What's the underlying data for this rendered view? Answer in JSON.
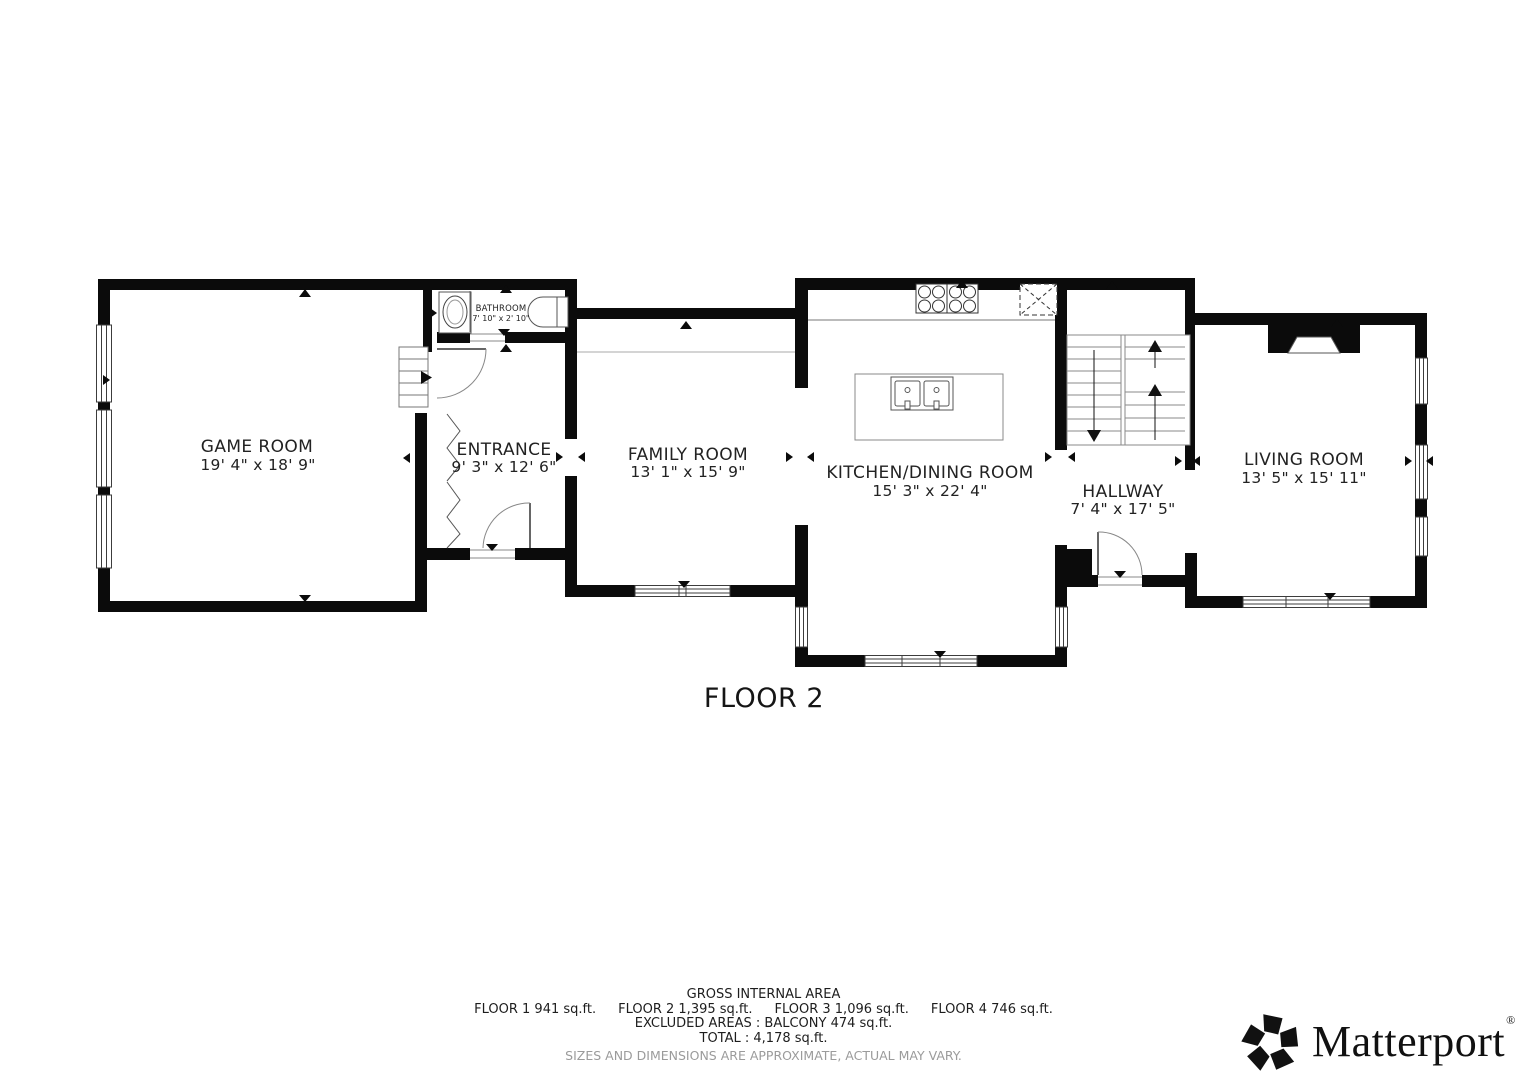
{
  "floor_plan": {
    "floor_label": "FLOOR 2",
    "rooms": {
      "game_room": {
        "name": "GAME ROOM",
        "dims": "19' 4\" x 18' 9\""
      },
      "entrance": {
        "name": "ENTRANCE",
        "dims": "9' 3\" x 12' 6\""
      },
      "bathroom": {
        "name": "BATHROOM",
        "dims": "7' 10\" x 2' 10\""
      },
      "family_room": {
        "name": "FAMILY ROOM",
        "dims": "13' 1\" x 15' 9\""
      },
      "kitchen_dining": {
        "name": "KITCHEN/DINING ROOM",
        "dims": "15' 3\" x 22' 4\""
      },
      "hallway": {
        "name": "HALLWAY",
        "dims": "7' 4\" x 17' 5\""
      },
      "living_room": {
        "name": "LIVING ROOM",
        "dims": "13' 5\" x 15' 11\""
      }
    }
  },
  "footer": {
    "title": "GROSS INTERNAL AREA",
    "floors": [
      "FLOOR 1 941 sq.ft.",
      "FLOOR 2 1,395 sq.ft.",
      "FLOOR 3 1,096 sq.ft.",
      "FLOOR 4 746 sq.ft."
    ],
    "excluded": "EXCLUDED AREAS :  BALCONY 474 sq.ft.",
    "total": "TOTAL :  4,178 sq.ft.",
    "disclaimer": "SIZES AND DIMENSIONS ARE APPROXIMATE, ACTUAL MAY VARY."
  },
  "branding": {
    "logo_text": "Matterport",
    "registered": "®"
  },
  "colors": {
    "wall": "#0b0b0b",
    "text": "#222222",
    "muted": "#9b9b9b"
  }
}
